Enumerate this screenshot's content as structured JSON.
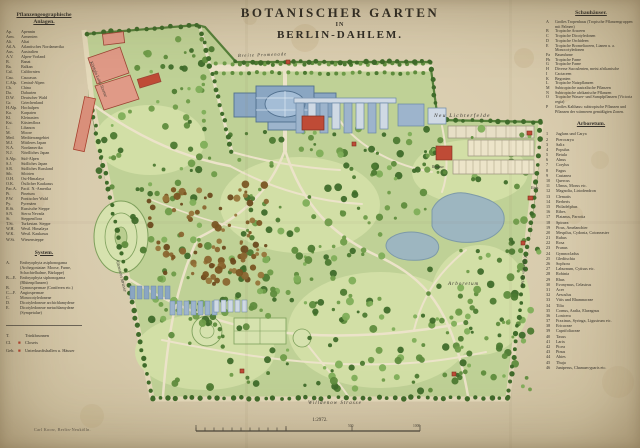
{
  "title": {
    "line1": "BOTANISCHER GARTEN",
    "line2": "IN",
    "line3": "BERLIN-DAHLEM."
  },
  "left_legend": {
    "heading1": "Pflanzengeographische",
    "heading2": "Anlagen.",
    "entries": [
      {
        "abbr": "Ap.",
        "name": "Apennin"
      },
      {
        "abbr": "Arm.",
        "name": "Armenien"
      },
      {
        "abbr": "Alt.",
        "name": "Altai"
      },
      {
        "abbr": "Atl.A.",
        "name": "Atlantisches Nordamerika"
      },
      {
        "abbr": "Aus.",
        "name": "Australien"
      },
      {
        "abbr": "A.V.",
        "name": "Alpen-Vorland"
      },
      {
        "abbr": "B.",
        "name": "Banat"
      },
      {
        "abbr": "Ba.",
        "name": "Balkan"
      },
      {
        "abbr": "Cal.",
        "name": "Californien"
      },
      {
        "abbr": "Cau.",
        "name": "Caucasus"
      },
      {
        "abbr": "C.Alp.",
        "name": "Central-Alpen"
      },
      {
        "abbr": "Ch.",
        "name": "China"
      },
      {
        "abbr": "Da.",
        "name": "Dahurien"
      },
      {
        "abbr": "D.W.",
        "name": "Deutscher Wald"
      },
      {
        "abbr": "Gr.",
        "name": "Griechenland"
      },
      {
        "abbr": "H.Alp.",
        "name": "Hochalpen"
      },
      {
        "abbr": "Ka.",
        "name": "Karpaten"
      },
      {
        "abbr": "Kl.",
        "name": "Kleinasien"
      },
      {
        "abbr": "Kst.",
        "name": "Küstenflora"
      },
      {
        "abbr": "L.",
        "name": "Libanon"
      },
      {
        "abbr": "M.",
        "name": "Moore"
      },
      {
        "abbr": "Med.",
        "name": "Mediterrangebiet"
      },
      {
        "abbr": "M.J.",
        "name": "Mittleres Japan"
      },
      {
        "abbr": "N.A.",
        "name": "Nordamerika"
      },
      {
        "abbr": "N.J.",
        "name": "Nördliches Japan"
      },
      {
        "abbr": "S.Alp.",
        "name": "Süd-Alpen"
      },
      {
        "abbr": "S.J.",
        "name": "Südliches Japan"
      },
      {
        "abbr": "S.R.",
        "name": "Südliches Russland"
      },
      {
        "abbr": "Sib.",
        "name": "Sibirien"
      },
      {
        "abbr": "O.H.",
        "name": "Ost-Himalaya"
      },
      {
        "abbr": "O.K.",
        "name": "Östlicher Kaukasus"
      },
      {
        "abbr": "Pac.A.",
        "name": "Pacif. N.-Amerika"
      },
      {
        "abbr": "Pi.",
        "name": "Pinetum"
      },
      {
        "abbr": "P.W.",
        "name": "Pontischer Wald"
      },
      {
        "abbr": "Py.",
        "name": "Pyrenäen"
      },
      {
        "abbr": "R.St.",
        "name": "Russische Steppe"
      },
      {
        "abbr": "S.N.",
        "name": "Sierra Nevada"
      },
      {
        "abbr": "St.",
        "name": "Steppenflora"
      },
      {
        "abbr": "T.St.",
        "name": "Turkestan. Steppe"
      },
      {
        "abbr": "W.H.",
        "name": "Westl. Himalaya"
      },
      {
        "abbr": "W.K.",
        "name": "Westl. Kaukasus"
      },
      {
        "abbr": "W.St.",
        "name": "Wiesensteppe"
      }
    ],
    "system_heading": "System.",
    "system_entries": [
      {
        "abbr": "A.",
        "name": "Embryophyta asiphonogama (Archegoniatae: Moose, Farne, Schachtelhalme, Bärlappe)"
      },
      {
        "abbr": "B—E.",
        "name": "Embryophyta siphonogama (Blütenpflanzen)"
      },
      {
        "abbr": "B.",
        "name": "Gymnospermae (Coniferen etc.)"
      },
      {
        "abbr": "C—F.",
        "name": "Angiospermae"
      },
      {
        "abbr": "C.",
        "name": "Monocotyledoneae"
      },
      {
        "abbr": "D.",
        "name": "Dicotyledoneae archichlamydeae"
      },
      {
        "abbr": "E.",
        "name": "Dicotyledoneae metachlamydeae (Sympetalae)"
      }
    ],
    "extras": [
      {
        "abbr": "T.",
        "sym": "",
        "name": "Trinkbrunnen"
      },
      {
        "abbr": "Cl.",
        "sym": "■",
        "name": "Closets"
      },
      {
        "abbr": "Geb.",
        "sym": "■",
        "name": "Unterkunftshallen u. Häuser"
      }
    ]
  },
  "right_legend": {
    "heading": "Schauhäuser.",
    "entries": [
      {
        "abbr": "A",
        "name": "Großes Tropenhaus (Tropische Pflanzengruppen mit Palmen)"
      },
      {
        "abbr": "B",
        "name": "Tropische Araceen"
      },
      {
        "abbr": "C",
        "name": "Tropische Dicotyledonen"
      },
      {
        "abbr": "D",
        "name": "Tropische Orchideen"
      },
      {
        "abbr": "E",
        "name": "Tropische Bromeliaceen, Lianen u. a. Monocotyledonen"
      },
      {
        "abbr": "Fa",
        "name": "Baumfarne"
      },
      {
        "abbr": "Fb",
        "name": "Tropische Farne"
      },
      {
        "abbr": "G",
        "name": "Tropische Farne"
      },
      {
        "abbr": "H",
        "name": "Diverse Succulenten, meist afrikanische"
      },
      {
        "abbr": "I",
        "name": "Cactaceen"
      },
      {
        "abbr": "K",
        "name": "Begonien"
      },
      {
        "abbr": "L",
        "name": "Tropische Nutzpflanzen"
      },
      {
        "abbr": "M",
        "name": "Subtropische australische Pflanzen"
      },
      {
        "abbr": "N",
        "name": "Subtropische afrikanische Pflanzen"
      },
      {
        "abbr": "O",
        "name": "Tropische Wasser- und Sumpfpflanzen (Victoria regia)"
      },
      {
        "abbr": "P",
        "name": "Großes Kalthaus: subtropische Pflanzen und Pflanzen der wärmeren gemäßigten Zonen."
      }
    ],
    "arboretum_heading": "Arboretum.",
    "arboretum_entries": [
      {
        "num": "1",
        "name": "Juglans und Carya"
      },
      {
        "num": "2",
        "name": "Pterocarya"
      },
      {
        "num": "3",
        "name": "Salix"
      },
      {
        "num": "4",
        "name": "Populus"
      },
      {
        "num": "5",
        "name": "Betula"
      },
      {
        "num": "6",
        "name": "Alnus"
      },
      {
        "num": "7",
        "name": "Corylus"
      },
      {
        "num": "8",
        "name": "Fagus"
      },
      {
        "num": "9",
        "name": "Castanea"
      },
      {
        "num": "10",
        "name": "Quercus"
      },
      {
        "num": "11",
        "name": "Ulmus, Morus etc."
      },
      {
        "num": "12",
        "name": "Magnolia, Liriodendron"
      },
      {
        "num": "13",
        "name": "Clematis"
      },
      {
        "num": "14",
        "name": "Berberis"
      },
      {
        "num": "15",
        "name": "Philadelphus"
      },
      {
        "num": "16",
        "name": "Ribes"
      },
      {
        "num": "17",
        "name": "Platanus, Parrotia"
      },
      {
        "num": "18",
        "name": "Spiraea"
      },
      {
        "num": "19",
        "name": "Pirus, Amelanchier"
      },
      {
        "num": "20",
        "name": "Mespilus, Cydonia, Cotoneaster"
      },
      {
        "num": "21",
        "name": "Rubus"
      },
      {
        "num": "22",
        "name": "Rosa"
      },
      {
        "num": "23",
        "name": "Prunus"
      },
      {
        "num": "24",
        "name": "Gymnocladus"
      },
      {
        "num": "25",
        "name": "Gleditschia"
      },
      {
        "num": "26",
        "name": "Sophora"
      },
      {
        "num": "27",
        "name": "Laburnum, Cytisus etc."
      },
      {
        "num": "28",
        "name": "Robinia"
      },
      {
        "num": "29",
        "name": "Rhus"
      },
      {
        "num": "30",
        "name": "Evonymus, Celastrus"
      },
      {
        "num": "31",
        "name": "Acer"
      },
      {
        "num": "32",
        "name": "Aesculus"
      },
      {
        "num": "33",
        "name": "Vitis und Rhamnaceae"
      },
      {
        "num": "34",
        "name": "Tilia"
      },
      {
        "num": "35",
        "name": "Cornus, Aralia, Elaeagnus"
      },
      {
        "num": "36",
        "name": "Lonicera"
      },
      {
        "num": "37",
        "name": "Fraxinus, Syringa, Ligustrum etc."
      },
      {
        "num": "38",
        "name": "Ericaceae"
      },
      {
        "num": "39",
        "name": "Caprifoliaceae"
      },
      {
        "num": "40",
        "name": "Taxus"
      },
      {
        "num": "41",
        "name": "Larix"
      },
      {
        "num": "42",
        "name": "Picea"
      },
      {
        "num": "43",
        "name": "Pinus"
      },
      {
        "num": "44",
        "name": "Abies"
      },
      {
        "num": "45",
        "name": "Thuja"
      },
      {
        "num": "46",
        "name": "Juniperus, Chamaecyparis etc."
      }
    ]
  },
  "map": {
    "labels": {
      "promenade": "Breite Promenade",
      "lichterfelde": "Neu Lichterfelde",
      "koenigin": "Königin Luise Strasse",
      "altenstein": "Altenstein Strasse",
      "willdenow": "Willdenow Strasse",
      "eichen": "Unter den Eichen",
      "arboretum": "Arboretum",
      "restaurant": "Restaur.",
      "eingang": "Eing."
    }
  },
  "footer": {
    "scale_text": "1:2972.",
    "credit": "Carl Koow, Berlin-Neukölln.",
    "bar_label_mid": "500",
    "bar_label_end": "1000"
  }
}
